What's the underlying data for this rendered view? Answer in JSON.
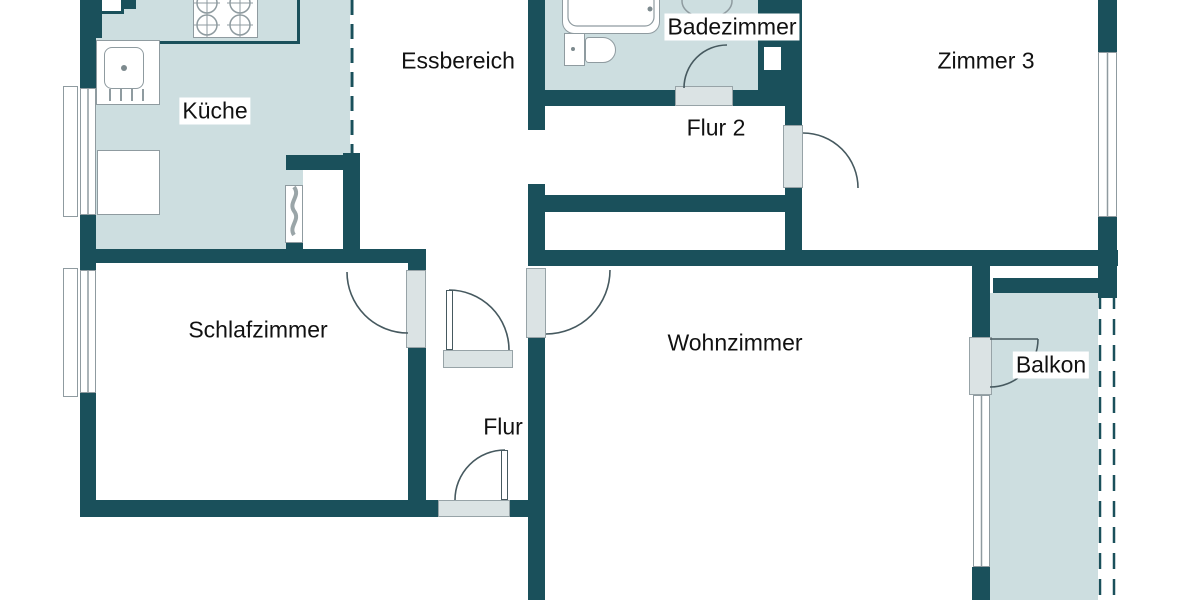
{
  "plan_type": "floor-plan",
  "rooms": [
    {
      "id": "kueche",
      "label": "Küche"
    },
    {
      "id": "essbereich",
      "label": "Essbereich"
    },
    {
      "id": "badezimmer",
      "label": "Badezimmer"
    },
    {
      "id": "flur-2",
      "label": "Flur 2"
    },
    {
      "id": "zimmer-3",
      "label": "Zimmer 3"
    },
    {
      "id": "schlafzimmer",
      "label": "Schlafzimmer"
    },
    {
      "id": "wohnzimmer",
      "label": "Wohnzimmer"
    },
    {
      "id": "flur",
      "label": "Flur"
    },
    {
      "id": "balkon",
      "label": "Balkon"
    }
  ],
  "fixtures": [
    {
      "name": "stove-icon"
    },
    {
      "name": "sink-icon"
    },
    {
      "name": "refrigerator-icon"
    },
    {
      "name": "bathtub-icon"
    },
    {
      "name": "toilet-icon"
    },
    {
      "name": "washbasin-icon"
    },
    {
      "name": "chimney-shaft-icon"
    }
  ],
  "colors": {
    "wall": "#1a505b",
    "room_fill": "#cddee0",
    "door_sill": "#dbe3e4",
    "sill_border": "#97a3a7",
    "fixture_outline": "#8f9ba0",
    "arc_line": "#46595f",
    "label_text": "#111111",
    "label_bg": "#ffffff"
  }
}
